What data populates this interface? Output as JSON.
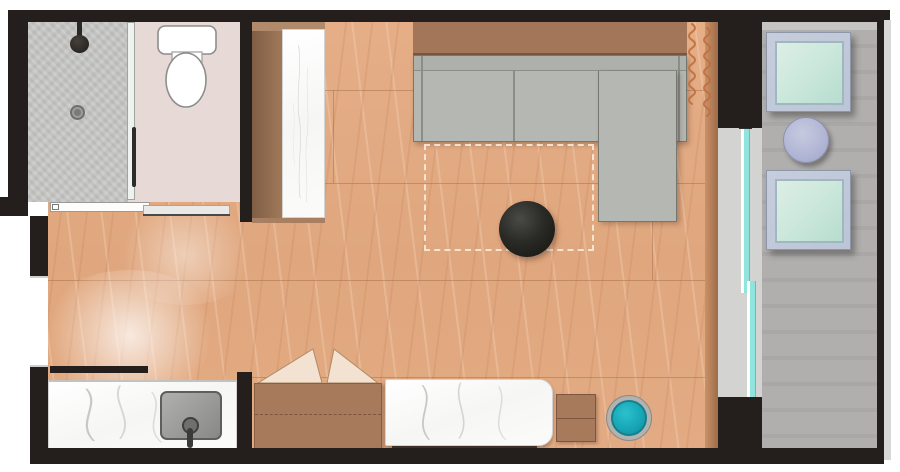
{
  "title": "Studio apartment floor plan",
  "colors": {
    "wall": "#241f1c",
    "floorWood": "#e0a77e",
    "tile": "#c7c7c5",
    "bathFloor": "#e7d9d5",
    "wardrobeDark": "#7f5e45",
    "wardrobeLight": "#a17859",
    "cabinetBrown": "#a87a5c",
    "consoleBrown": "#a3765a",
    "sofaGray": "#b5b7b3",
    "sofaBack": "#aeb0ac",
    "benchDark": "#4c3e34",
    "stoolTeal": "#17a7b7",
    "stoolRim": "#b2b2b0",
    "balconyFloor": "#b1afad",
    "sill": "#d3d3d1",
    "glassCyan": "#8fe4de",
    "tableFrame": "#bcc5d6",
    "tableGlass": "#cde8dc",
    "roundTable": "#b3b7d6",
    "curtain": "#bf6f3f",
    "cream": "#f3e2d2",
    "trim": "#d8d8d6"
  },
  "rooms": [
    {
      "name": "bathroom",
      "features": [
        "walk-in-shower",
        "rain-shower-head",
        "floor-drain",
        "glass-partition",
        "toilet",
        "sliding-door"
      ]
    },
    {
      "name": "living-area",
      "features": [
        "wardrobe",
        "tall-marble-counter",
        "media-console",
        "sectional-sofa",
        "chaise-lounge",
        "round-black-pouf",
        "fold-out-bed-outline",
        "curtain"
      ]
    },
    {
      "name": "kitchen",
      "features": [
        "marble-worktop",
        "undermount-sink",
        "mixer-tap",
        "partition-wall"
      ]
    },
    {
      "name": "dining-nook",
      "features": [
        "storage-cabinet-with-bifold-doors",
        "marble-dining-table",
        "bench-seat",
        "drawer-unit",
        "teal-stool"
      ]
    },
    {
      "name": "balcony",
      "features": [
        "sliding-glass-door",
        "square-glass-table",
        "round-side-table",
        "square-glass-table"
      ]
    }
  ]
}
